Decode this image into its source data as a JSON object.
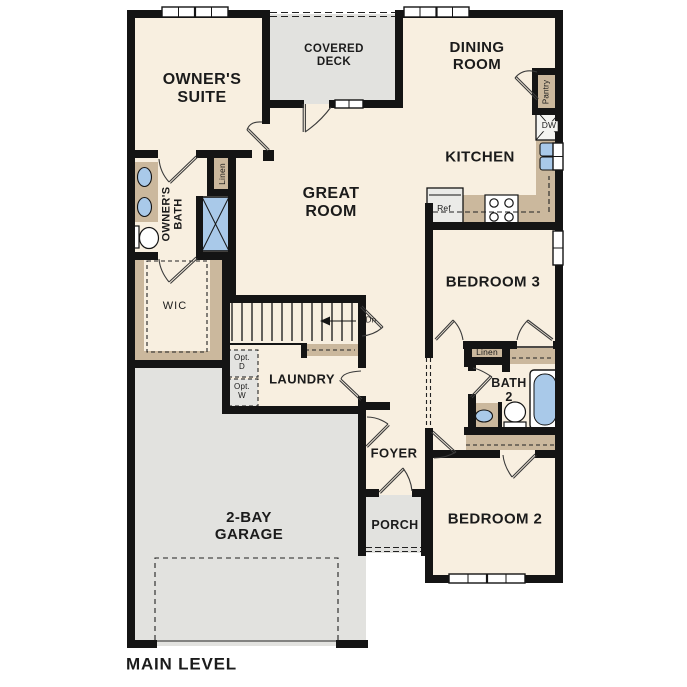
{
  "title": "MAIN LEVEL",
  "colors": {
    "wall": "#141414",
    "floor": "#f8efe0",
    "outdoor_gray": "#e2e2df",
    "counter_tan": "#cbb89d",
    "fixture_blue": "#a9c9e9",
    "optional_gray": "#e4e4e1"
  },
  "labels": {
    "owners_suite": "OWNER'S\nSUITE",
    "covered_deck": "COVERED\nDECK",
    "dining_room": "DINING\nROOM",
    "kitchen": "KITCHEN",
    "great_room": "GREAT\nROOM",
    "owners_bath": "OWNER'S\nBATH",
    "linen_owners": "Linen",
    "wic": "WIC",
    "laundry": "LAUNDRY",
    "opt_d": "Opt.\nD",
    "opt_w": "Opt.\nW",
    "dn": "Dn",
    "foyer": "FOYER",
    "porch": "PORCH",
    "garage": "2-BAY\nGARAGE",
    "bedroom3": "BEDROOM 3",
    "linen_hall": "Linen",
    "bath2": "BATH\n2",
    "bedroom2": "BEDROOM 2",
    "pantry": "Pantry",
    "dw": "DW",
    "ref": "Ref",
    "main_level": "MAIN LEVEL"
  }
}
